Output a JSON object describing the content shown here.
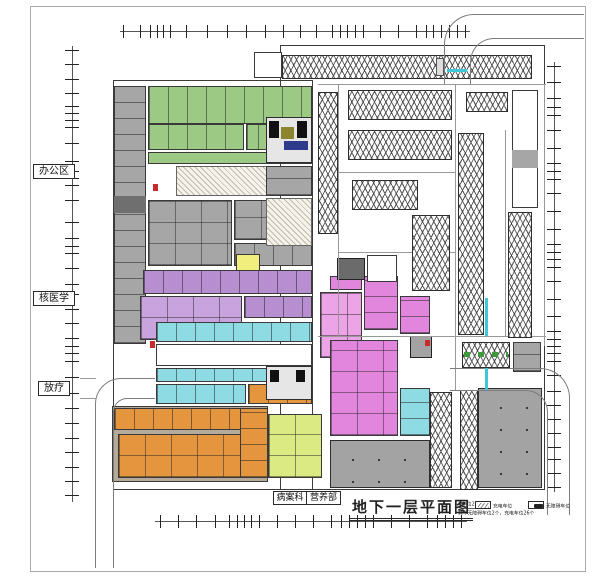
{
  "palette": {
    "green": "#9cca84",
    "gray_room": "#a6a6a6",
    "gray_dark": "#6f6f6f",
    "purple": "#b78fd0",
    "purple_light": "#c9a3dd",
    "cyan": "#8fdbe4",
    "yellow": "#f1ee7e",
    "lime": "#dcea83",
    "orange": "#e6953f",
    "tan": "#b5a99a",
    "magenta": "#e286dd",
    "magenta_light": "#eda4e6",
    "hall_gray": "#a3a3a3",
    "core_light": "#e6e6e6",
    "core_dark": "#6b6b6b",
    "navy": "#2e3a8c",
    "olive": "#8c8530",
    "red": "#c92a2a",
    "gate_cyan": "#3fc6d8",
    "white": "#ffffff"
  },
  "labels": {
    "side": [
      {
        "text": "办公区"
      },
      {
        "text": "核医学"
      },
      {
        "text": "放疗"
      }
    ],
    "bottom": [
      {
        "text": "病案科"
      },
      {
        "text": "营养部"
      }
    ]
  },
  "titleblock": {
    "title": "地下一层平面图",
    "stat_line1": "车位229个",
    "stat_line2": "其中无障碍车位2个，充电车位26个",
    "legend": [
      {
        "label": "充电车位"
      },
      {
        "label": "无障碍车位"
      }
    ]
  }
}
